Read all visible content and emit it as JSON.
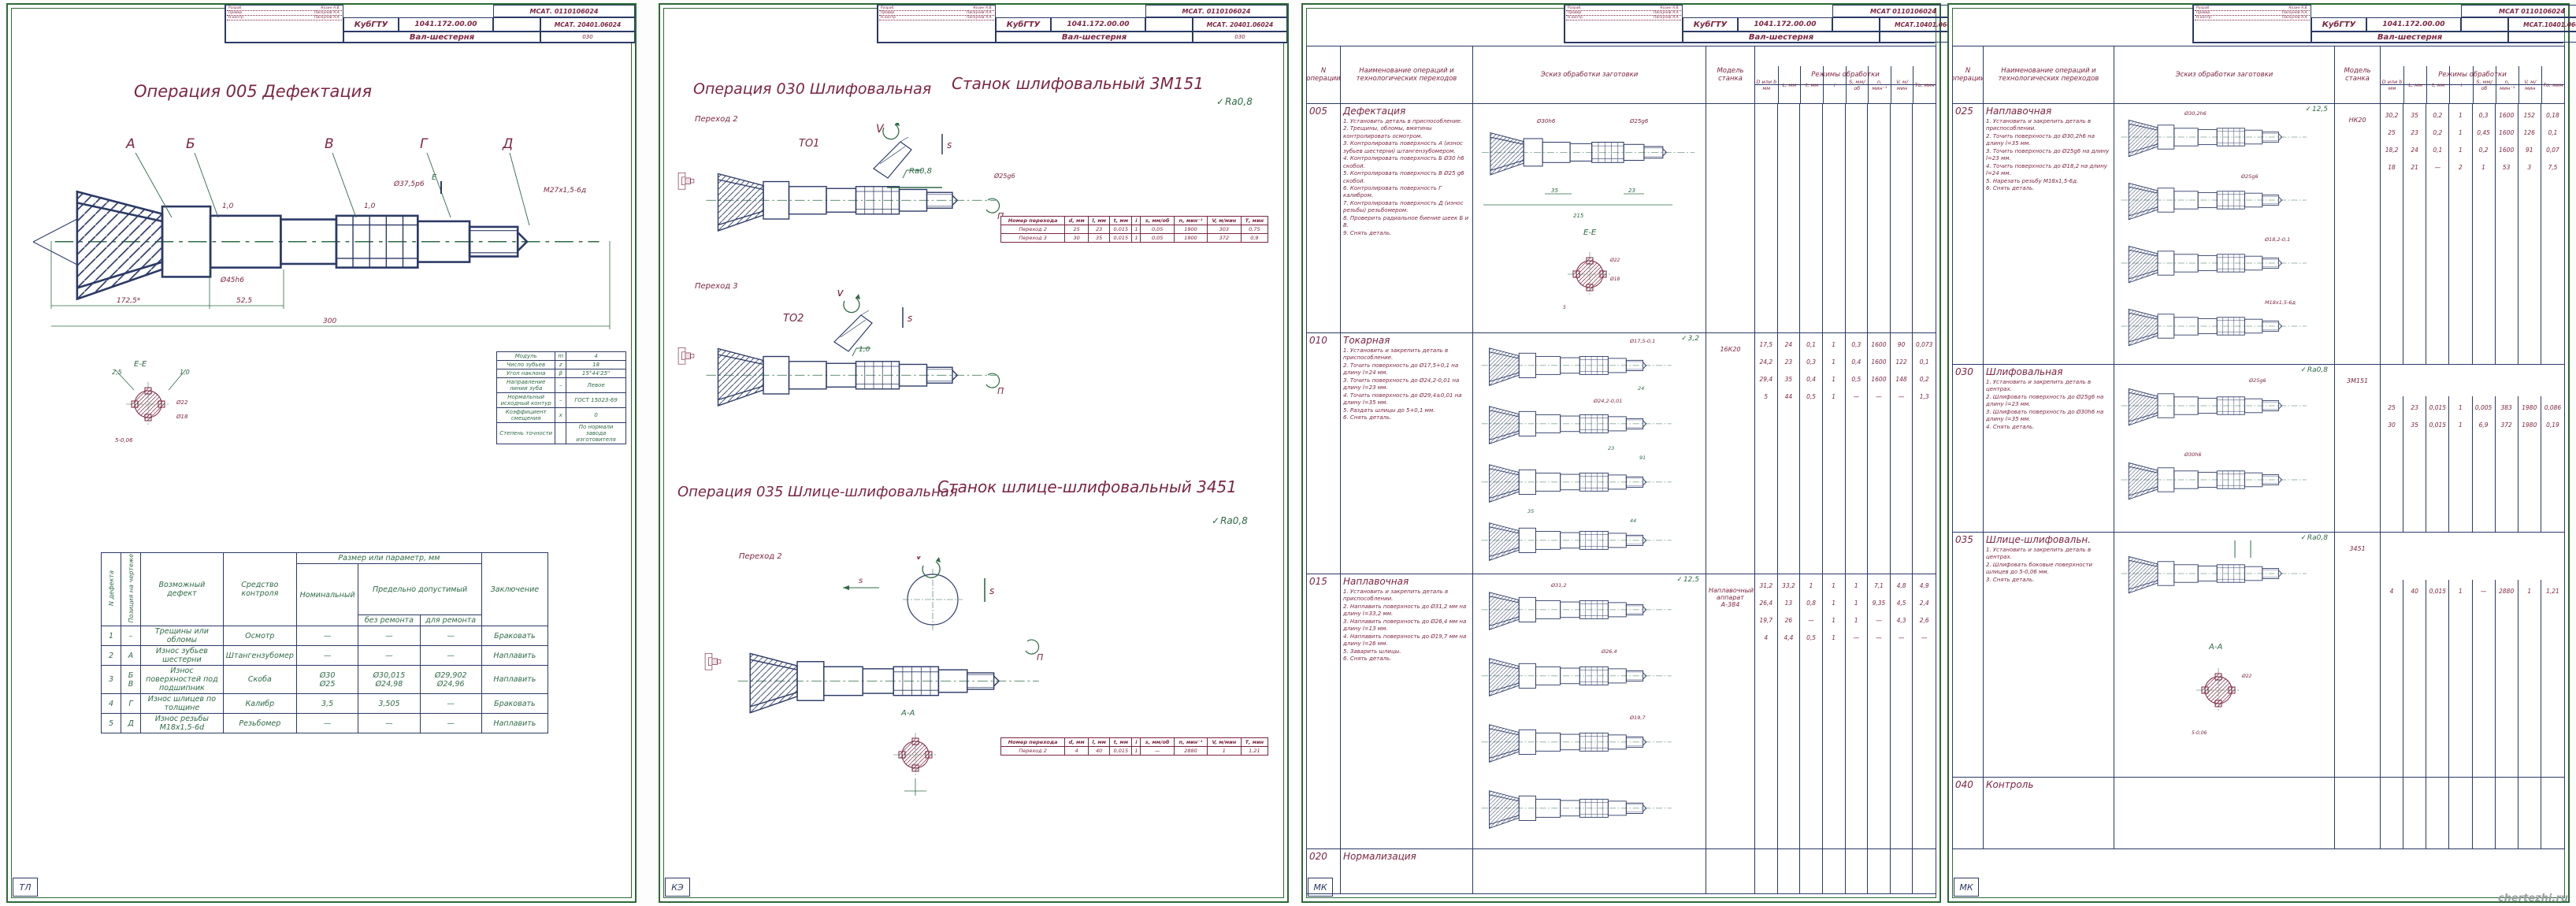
{
  "watermark": "chertezhi.ru",
  "sheet1": {
    "stamp": {
      "doc_top": "МСАТ. 0110106024",
      "org": "КубГТУ",
      "drawing_no": "1041.172.00.00",
      "doc_no": "МСАТ. 20401.06024",
      "part": "Вал-шестерня",
      "page": "030",
      "signs": [
        [
          "Разраб.",
          "Козин А.В."
        ],
        [
          "Провер.",
          "Пискунов А.А."
        ],
        [
          "Н.контр.",
          "Пискунов А.А."
        ]
      ]
    },
    "title": "Операция 005 Дефектация",
    "drawing": {
      "pos_a": "А",
      "pos_b": "Б",
      "pos_v": "В",
      "pos_g": "Г",
      "pos_d": "Д",
      "sec_ptr": "Е",
      "chamfer1": "1,0",
      "chamfer2": "1,0",
      "d375": "Ø37,5р6",
      "d45": "Ø45h6",
      "thread": "М27х1,5-6д",
      "dim_1725": "172,5*",
      "dim_525": "52,5",
      "dim_300": "300"
    },
    "section": {
      "label": "Е-Е",
      "c1": "2,5",
      "c2": "1,0",
      "d22": "Ø22",
      "d18": "Ø18",
      "w5": "5-0,06"
    },
    "params": {
      "rows": [
        [
          "Модуль",
          "m",
          "4"
        ],
        [
          "Число зубьев",
          "z",
          "18"
        ],
        [
          "Угол наклона",
          "β",
          "15°44'25\""
        ],
        [
          "Направление линии зуба",
          "–",
          "Левое"
        ],
        [
          "Нормальный исходный контур",
          "–",
          "ГОСТ 15023-69"
        ],
        [
          "Коэффициент смещения",
          "x",
          "0"
        ],
        [
          "Степень точности",
          "",
          "По нормали завода изготовителя"
        ]
      ]
    },
    "defects": {
      "h_num": "N дефекта",
      "h_pos": "Позиция на чертеже",
      "h_def": "Возможный дефект",
      "h_ctrl": "Средство контроля",
      "h_size": "Размер или параметр, мм",
      "h_nom": "Номинальный",
      "h_lim": "Предельно допустимый",
      "h_norep": "без ремонта",
      "h_rep": "для ремонта",
      "h_concl": "Заключение",
      "rows": [
        [
          "1",
          "–",
          "Трещины или обломы",
          "Осмотр",
          "—",
          "—",
          "—",
          "Браковать"
        ],
        [
          "2",
          "А",
          "Износ зубьев шестерни",
          "Штангензубомер",
          "—",
          "—",
          "—",
          "Наплавить"
        ],
        [
          "3",
          "Б\nВ",
          "Износ поверхностей под подшипник",
          "Скоба",
          "Ø30\nØ25",
          "Ø30,015\nØ24,98",
          "Ø29,902\nØ24,96",
          "Наплавить"
        ],
        [
          "4",
          "Г",
          "Износ шлицев по толщине",
          "Калибр",
          "3,5",
          "3,505",
          "—",
          "Браковать"
        ],
        [
          "5",
          "Д",
          "Износ резьбы М18х1,5-6d",
          "Резьбомер",
          "—",
          "—",
          "—",
          "Наплавить"
        ]
      ]
    },
    "corner": "ТЛ"
  },
  "sheet2": {
    "stamp": {
      "doc_top": "МСАТ. 0110106024",
      "org": "КубГТУ",
      "drawing_no": "1041.172.00.00",
      "doc_no": "МСАТ. 20401.06024",
      "part": "Вал-шестерня",
      "page": "030",
      "signs": [
        [
          "Разраб.",
          "Козин А.В."
        ],
        [
          "Провер.",
          "Пискунов А.А."
        ],
        [
          "Н.контр.",
          "Пискунов А.А."
        ]
      ]
    },
    "op030_title": "Операция 030 Шлифовальная",
    "op030_machine": "Станок шлифовальный 3М151",
    "ra": "Ra0,8",
    "perehod2": "Переход 2",
    "to1": "ТО1",
    "perehod3": "Переход 3",
    "to2": "ТО2",
    "v": "V",
    "s": "s",
    "sp": "s",
    "n": "П",
    "d25": "Ø25g6",
    "chamfer": "1,0",
    "table1": {
      "headers": [
        "Номер перехода",
        "d, мм",
        "l, мм",
        "t, мм",
        "i",
        "s, мм/об",
        "n, мин⁻¹",
        "V, м/мин",
        "Т, мин"
      ],
      "rows": [
        [
          "Переход 2",
          "25",
          "23",
          "0,015",
          "1",
          "0,05",
          "1900",
          "303",
          "0,75"
        ],
        [
          "Переход 3",
          "30",
          "35",
          "0,015",
          "1",
          "0,05",
          "1900",
          "372",
          "0,9"
        ]
      ]
    },
    "op035_title": "Операция 035 Шлице-шлифовальная",
    "op035_machine": "Станок шлице-шлифовальный 3451",
    "ra2": "Ra0,8",
    "perehod2b": "Переход 2",
    "aa": "А-А",
    "table2": {
      "headers": [
        "Номер перехода",
        "d, мм",
        "l, мм",
        "t, мм",
        "i",
        "s, мм/об",
        "n, мин⁻¹",
        "V, м/мин",
        "Т, мин"
      ],
      "rows": [
        [
          "Переход 2",
          "4",
          "40",
          "0,015",
          "1",
          "—",
          "2880",
          "1",
          "1,21"
        ]
      ]
    },
    "corner": "КЭ"
  },
  "sheet3": {
    "stamp": {
      "doc_top": "МСАТ 0110106024",
      "org": "КубГТУ",
      "drawing_no": "1041.172.00.00",
      "doc_no": "МСАТ.10401.06024",
      "part": "Вал-шестерня",
      "page": "",
      "signs": [
        [
          "Разраб.",
          "Козин А.В."
        ],
        [
          "Провер.",
          "Пискунов А.А."
        ],
        [
          "Н.контр.",
          "Пискунов А.А."
        ]
      ]
    },
    "head": {
      "op": "N операции",
      "name": "Наименование операций и технологических переходов",
      "sketch": "Эскиз обработки заготовки",
      "model": "Модель станка",
      "modes": "Режимы обработки",
      "mode_cols": [
        "D или b мм",
        "L, мм",
        "t, мм",
        "i",
        "S, мм/об",
        "n, мин⁻¹",
        "V, м/мин",
        "То, мин"
      ]
    },
    "rows": [
      {
        "op": "005",
        "name": "Дефектация",
        "steps": "1. Установить деталь в приспособление.\n2. Трещины, обломы, вмятины контролировать осмотром.\n3. Контролировать поверхность А (износ зубьев шестерни) штангензубомером.\n4. Контролировать поверхность Б Ø30 h6 скобой.\n5. Контролировать поверхность В Ø25 g6 скобой.\n6. Контролировать поверхность Г калибром.\n7. Контролировать поверхность Д (износ резьбы) резьбомером.\n8. Проверить радиальное биение шеек Б и В.\n9. Снять деталь.",
        "model": "",
        "ra": "",
        "sk1": "Ø30h6",
        "sk2": "Ø25g6",
        "sk3": "215",
        "sk4": "35",
        "sk5": "23",
        "sec": "Е-Е",
        "sec1": "Ø22",
        "sec2": "Ø18",
        "sec3": "5",
        "values": []
      },
      {
        "op": "010",
        "name": "Токарная",
        "steps": "1. Установить и закрепить деталь в приспособление.\n2. Точить поверхность до Ø17,5+0,1 на длину l=24 мм.\n3. Точить поверхность до Ø24,2-0,01 на длину l=23 мм.\n4. Точить поверхность до Ø29,4±0,01 на длину l=35 мм.\n5. Раздать шлицы до 5+0,1 мм.\n6. Снять деталь.",
        "model": "16К20",
        "ra": "3,2",
        "sk1": "Ø17,5-0,1",
        "sk2": "Ø24,2-0,01",
        "sk3": "24",
        "sk4": "23",
        "sk5": "91",
        "sk6": "35",
        "sk7": "44",
        "values": [
          [
            "17,5",
            "24",
            "0,1",
            "1",
            "0,3",
            "1600",
            "90",
            "0,073"
          ],
          [
            "24,2",
            "23",
            "0,3",
            "1",
            "0,4",
            "1600",
            "122",
            "0,1"
          ],
          [
            "29,4",
            "35",
            "0,4",
            "1",
            "0,5",
            "1600",
            "148",
            "0,2"
          ],
          [
            "5",
            "44",
            "0,5",
            "1",
            "—",
            "—",
            "—",
            "1,3"
          ]
        ]
      },
      {
        "op": "015",
        "name": "Наплавочная",
        "steps": "1. Установить и закрепить деталь в приспособлении.\n2. Наплавить поверхность до Ø31,2 мм на длину l=33,2 мм.\n3. Наплавить поверхность до Ø26,4 мм на длину l=13 мм.\n4. Наплавить поверхность до Ø19,7 мм на длину l=26 мм.\n5. Заварить шлицы.\n6. Снять деталь.",
        "model": "Наплавочный аппарат А-384",
        "ra": "12,5",
        "sk1": "Ø31,2",
        "sk2": "Ø26,4",
        "sk3": "Ø19,7",
        "values": [
          [
            "31,2",
            "33,2",
            "1",
            "1",
            "1",
            "7,1",
            "4,8",
            "4,9"
          ],
          [
            "26,4",
            "13",
            "0,8",
            "1",
            "1",
            "9,35",
            "4,5",
            "2,4"
          ],
          [
            "19,7",
            "26",
            "—",
            "1",
            "1",
            "—",
            "4,3",
            "2,6"
          ],
          [
            "4",
            "4,4",
            "0,5",
            "1",
            "—",
            "—",
            "—",
            "—"
          ]
        ]
      },
      {
        "op": "020",
        "name": "Нормализация",
        "steps": "",
        "model": "",
        "ra": "",
        "values": []
      }
    ],
    "corner": "МК"
  },
  "sheet4": {
    "stamp": {
      "doc_top": "МСАТ 0110106024",
      "org": "КубГТУ",
      "drawing_no": "1041.172.00.00",
      "doc_no": "МСАТ.10401.06024",
      "part": "Вал-шестерня",
      "page": "",
      "signs": [
        [
          "Разраб.",
          "Козин А.В."
        ],
        [
          "Провер.",
          "Пискунов А.А."
        ],
        [
          "Н.контр.",
          "Пискунов А.А."
        ]
      ]
    },
    "head": {
      "op": "N операции",
      "name": "Наименование операций и технологических переходов",
      "sketch": "Эскиз обработки заготовки",
      "model": "Модель станка",
      "modes": "Режимы обработки",
      "mode_cols": [
        "D или b мм",
        "L, мм",
        "t, мм",
        "i",
        "S, мм/об",
        "n, мин⁻¹",
        "V, м/мин",
        "То, мин"
      ]
    },
    "rows": [
      {
        "op": "025",
        "name": "Наплавочная",
        "steps": "1. Установить и закрепить деталь в приспособлении.\n2. Точить поверхность до Ø30,2h6 на длину l=35 мм.\n3. Точить поверхность до Ø25g6 на длину l=23 мм.\n4. Точить поверхность до Ø18,2 на длину l=24 мм.\n5. Нарезать резьбу М18х1,5-6д.\n6. Снять деталь.",
        "model": "НК20",
        "ra": "12,5",
        "sk1": "Ø30,2h6",
        "sk2": "Ø25g6",
        "sk3": "Ø18,2-0,1",
        "sk4": "М18х1,5-6д",
        "values": [
          [
            "30,2",
            "35",
            "0,2",
            "1",
            "0,3",
            "1600",
            "152",
            "0,18"
          ],
          [
            "25",
            "23",
            "0,2",
            "1",
            "0,45",
            "1600",
            "126",
            "0,1"
          ],
          [
            "18,2",
            "24",
            "0,1",
            "1",
            "0,2",
            "1600",
            "91",
            "0,07"
          ],
          [
            "18",
            "21",
            "—",
            "2",
            "1",
            "53",
            "3",
            "7,5"
          ]
        ]
      },
      {
        "op": "030",
        "name": "Шлифовальная",
        "steps": "1. Установить и закрепить деталь в центрах.\n2. Шлифовать поверхность до Ø25g6 на длину l=23 мм.\n3. Шлифовать поверхность до Ø30h6 на длину l=35 мм.\n4. Снять деталь.",
        "model": "3М151",
        "ra": "Ra0,8",
        "sk1": "Ø25g6",
        "sk2": "Ø30h6",
        "values": [
          [
            "25",
            "23",
            "0,015",
            "1",
            "0,005",
            "383",
            "1980",
            "0,086"
          ],
          [
            "30",
            "35",
            "0,015",
            "1",
            "6,9",
            "372",
            "1980",
            "0,19"
          ]
        ]
      },
      {
        "op": "035",
        "name": "Шлице-шлифовальн.",
        "steps": "1. Установить и закрепить деталь в центрах.\n2. Шлифовать боковые поверхности шлицев до 5-0,06 мм.\n3. Снять деталь.",
        "model": "3451",
        "ra": "Ra0,8",
        "aa": "А-А",
        "sk1": "Ø22",
        "sk2": "5-0,06",
        "values": [
          [
            "4",
            "40",
            "0,015",
            "1",
            "—",
            "2880",
            "1",
            "1,21"
          ]
        ]
      },
      {
        "op": "040",
        "name": "Контроль",
        "steps": "",
        "model": "",
        "ra": "",
        "values": []
      }
    ],
    "corner": "МК"
  }
}
